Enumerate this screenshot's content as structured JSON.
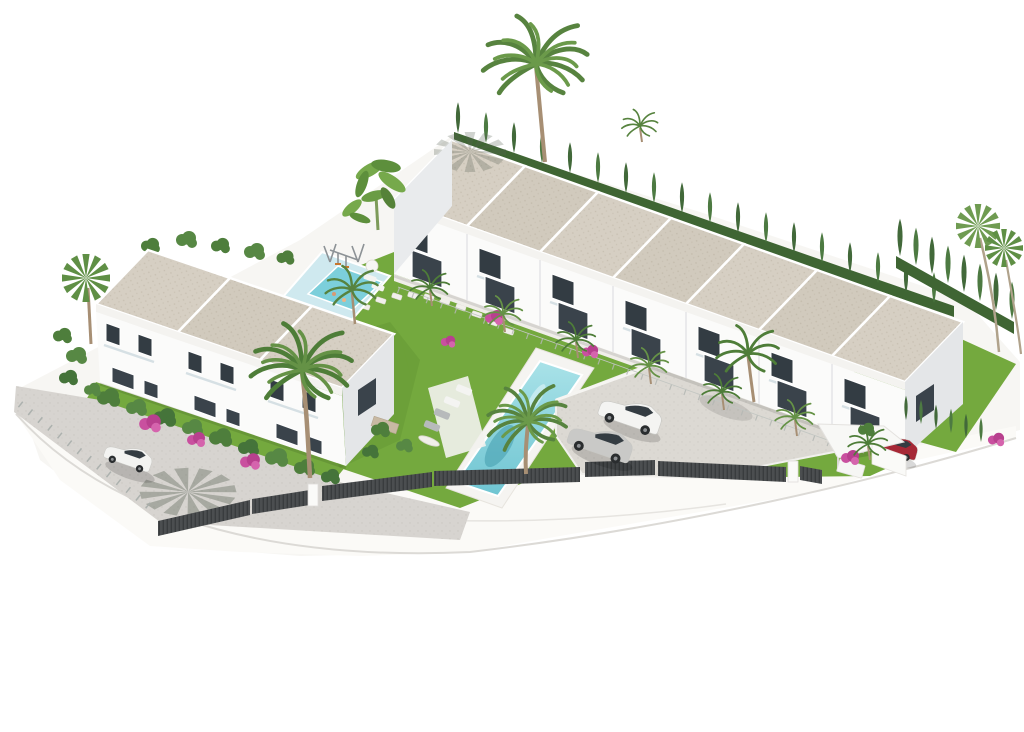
{
  "scene": {
    "description": "Aerial isometric 3D architectural rendering of a white Mediterranean townhouse development with communal pool, children's pool, gardens, parking and palm trees on a plain white background",
    "background": "#ffffff"
  },
  "colors": {
    "roof": "#d6cfc3",
    "wall": "#fbfbfa",
    "wall_shade": "#e4e6e8",
    "window": "#333c43",
    "grass": "#74a93e",
    "grass_dark": "#5e8f31",
    "hedge": "#3f6533",
    "cypress": "#42693a",
    "pool": "#7ccfdb",
    "pool_light": "#b5e7ec",
    "kids_deck": "#cfe9ef",
    "pavement": "#d7d4d0",
    "parking": "#dcd9d3",
    "fence": "#4b4e50",
    "deck_white": "#f5f4f1",
    "bougainvillea": "#c9509f",
    "trunk": "#a78f74"
  },
  "buildings": {
    "main_row": {
      "label": "terraced townhouse row",
      "units": 7,
      "storeys": 2
    },
    "left_block": {
      "label": "townhouse block",
      "units": 3,
      "storeys": 2
    }
  },
  "amenities": {
    "main_pool": {
      "label": "communal swimming pool"
    },
    "kids_pool": {
      "label": "children's pool with playground deck"
    },
    "sun_loungers": 6,
    "parasols": 2,
    "swing_set": 1,
    "carport": 1
  },
  "vehicles": [
    {
      "label": "white hatchback on side street",
      "color": "#f3f3f1"
    },
    {
      "label": "white suv in parking",
      "color": "#f4f4f2"
    },
    {
      "label": "silver sedan in parking",
      "color": "#c9c9c7"
    },
    {
      "label": "red car under carport",
      "color": "#a62836"
    }
  ],
  "landscaping": {
    "palm_trees": "many",
    "cypress_hedges": true,
    "banana_plants": true,
    "bougainvillea": true,
    "lawns": true
  }
}
